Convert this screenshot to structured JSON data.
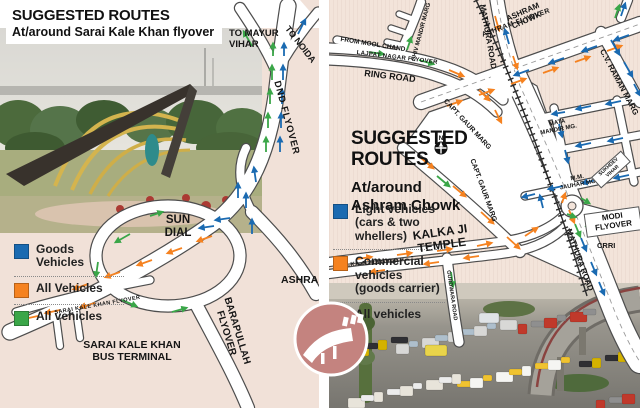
{
  "colors": {
    "blue": "#1a6ab1",
    "orange": "#f58220",
    "green": "#3aa648",
    "beige_left": "#f1e1d8",
    "beige_right": "#f3e4da",
    "road_casing": "#4d4d4d",
    "logo_rose": "#c4837f"
  },
  "left": {
    "title": "SUGGESTED ROUTES",
    "subtitle": "At/around Sarai Kale Khan flyover",
    "labels": {
      "to_mayur_1": "TO MAYUR",
      "to_mayur_2": "VIHAR",
      "to_noida": "TO NOIDA",
      "dnd_flyover": "DND FLYOVER",
      "sun_dial_1": "SUN",
      "sun_dial_2": "DIAL",
      "ashram": "ASHRAM",
      "skk_flyover": "SARAI KALE KHAN FLYOVER",
      "bus_terminal_1": "SARAI KALE KHAN",
      "bus_terminal_2": "BUS TERMINAL",
      "barapullah": "BARAPULLAH FLYOVER"
    },
    "legend": [
      {
        "color": "#1a6ab1",
        "label": "Goods Vehicles"
      },
      {
        "color": "#f58220",
        "label": "All Vehicles"
      },
      {
        "color": "#3aa648",
        "label": "All vehicles"
      }
    ]
  },
  "right": {
    "title_1": "SUGGESTED",
    "title_2": "ROUTES",
    "compass": "N",
    "subtitle_1": "At/around",
    "subtitle_2": "Ashram Chowk",
    "labels": {
      "mathura_road_top": "MATHURA ROAD",
      "ashram_chowk_1": "ASHRAM",
      "ashram_chowk_2": "CHOWK",
      "ashram_flyover": "ASHRAM FLYOVER",
      "cv_raman_marg": "C.V. RAMAN MARG",
      "from_mool_chand": "FROM MOOL CHAND",
      "lajpat_nagar_flyover": "LAJPAT NAGAR FLYOVER",
      "ring_road": "RING ROAD",
      "shiv_mandir_marg": "SHIV MANDIR MARG",
      "capt_gaur_marg_upper": "CAPT. GAUR MARG",
      "capt_gaur_marg_lower": "CAPT. GAUR MARG",
      "mata_mandir_1": "MATA",
      "mata_mandir_2": "MANDIR MG.",
      "mm_jauhar_1": "M.M.",
      "mm_jauhar_2": "JAUHAR MG.",
      "sukhdev_1": "SUKHDEV",
      "sukhdev_2": "VIHAR",
      "modi_1": "MODI",
      "modi_2": "FLYOVER",
      "mathura_road_lower": "MATHURA ROAD",
      "crri": "CRRI",
      "kalka_temple_1": "KALKA JI",
      "kalka_temple_2": "TEMPLE",
      "kalka_flyover": "KALKA JI FLYOVER",
      "gurdwara_rd": "GURDWARA ROAD"
    },
    "legend": [
      {
        "color": "#1a6ab1",
        "label": "Light vehicles (cars & two whellers)"
      },
      {
        "color": "#f58220",
        "label": "Commercial vehicles (goods carrier)"
      },
      {
        "color": "#3aa648",
        "label": "All vehicles"
      }
    ]
  }
}
